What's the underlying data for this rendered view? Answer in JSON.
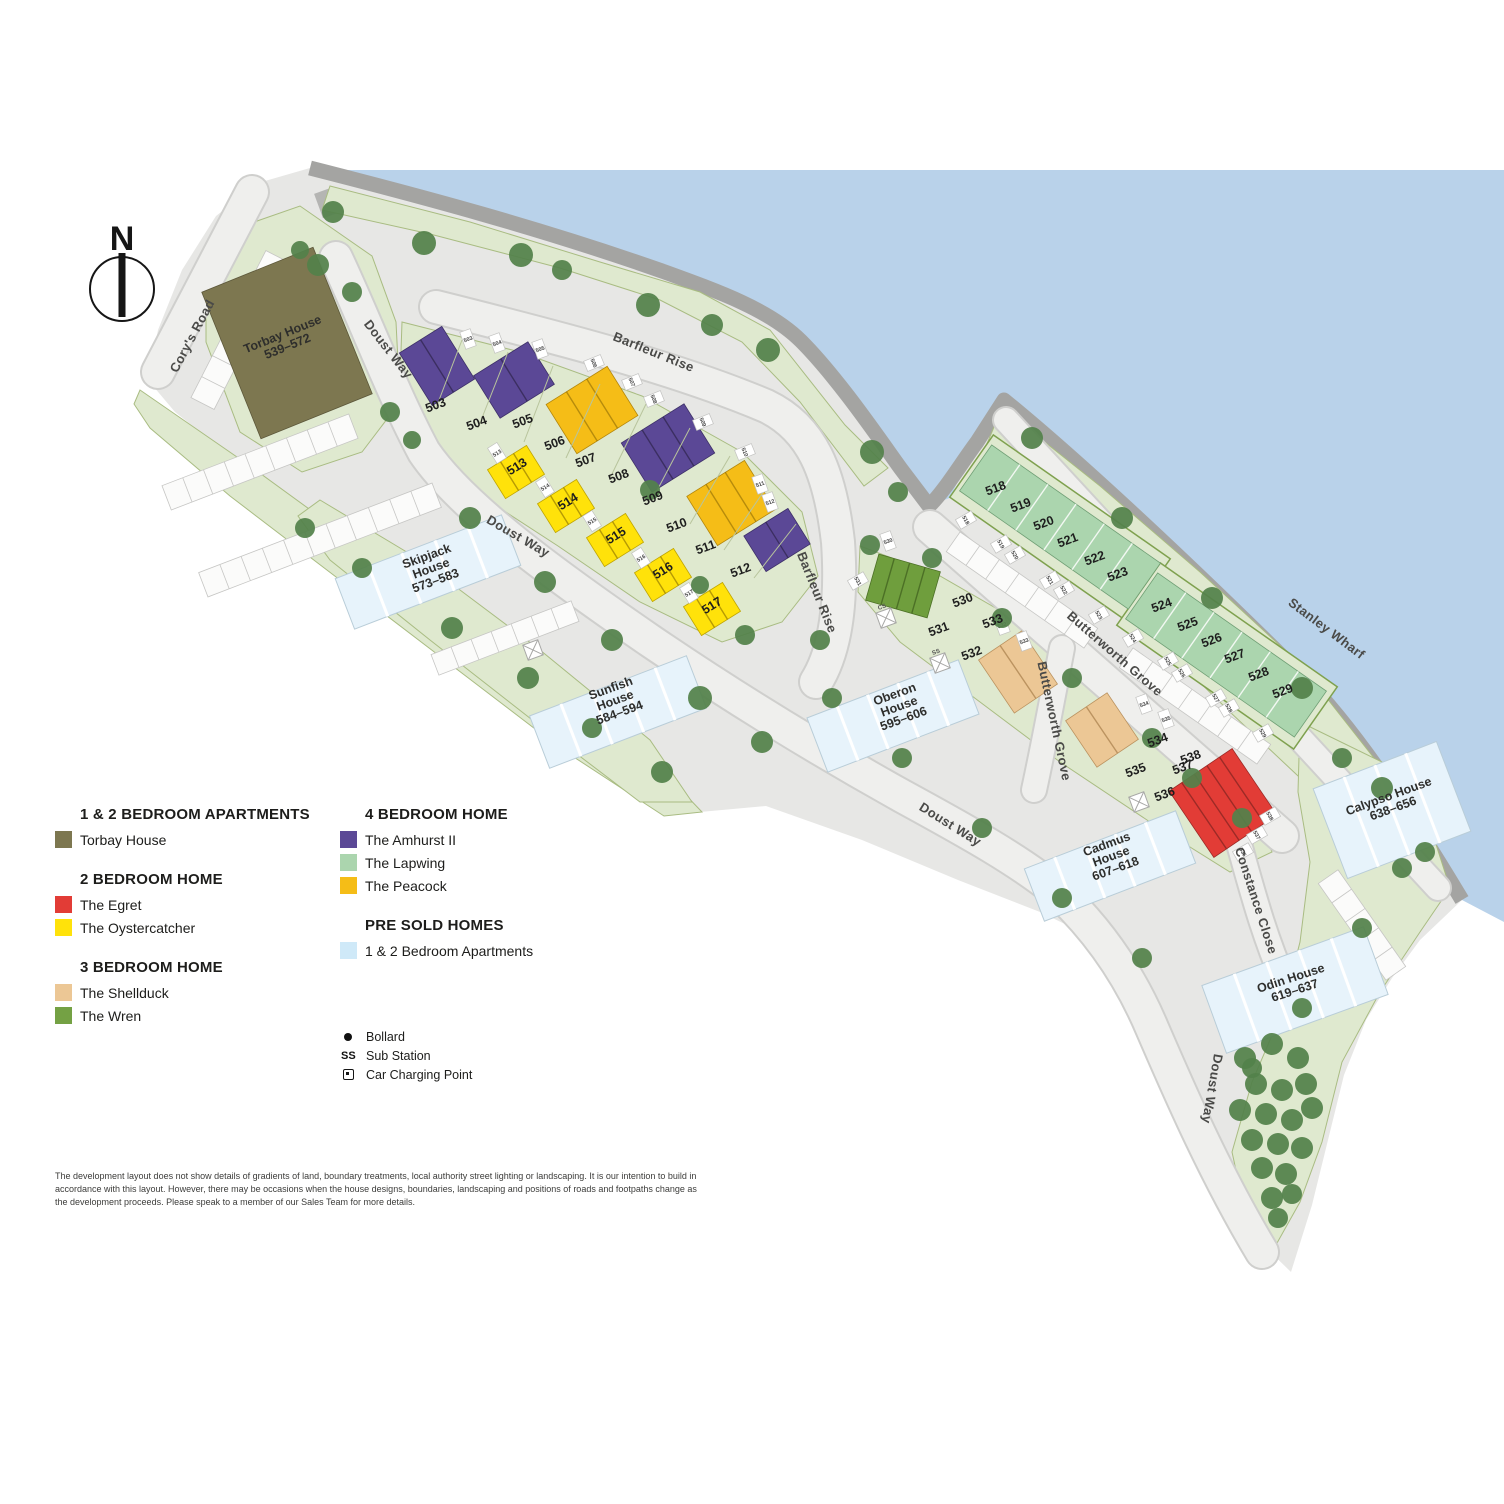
{
  "compass": {
    "label": "N"
  },
  "legend": {
    "sections": [
      {
        "title": "1 & 2 BEDROOM APARTMENTS",
        "items": [
          {
            "label": "Torbay House",
            "color": "#7d7750"
          }
        ]
      },
      {
        "title": "2 BEDROOM HOME",
        "items": [
          {
            "label": "The Egret",
            "color": "#e23c36"
          },
          {
            "label": "The Oystercatcher",
            "color": "#ffe20a"
          }
        ]
      },
      {
        "title": "3 BEDROOM HOME",
        "items": [
          {
            "label": "The Shellduck",
            "color": "#ecc795"
          },
          {
            "label": "The Wren",
            "color": "#74a144"
          }
        ]
      },
      {
        "title": "4 BEDROOM HOME",
        "items": [
          {
            "label": "The Amhurst II",
            "color": "#5b4896"
          },
          {
            "label": "The Lapwing",
            "color": "#abd5ae"
          },
          {
            "label": "The Peacock",
            "color": "#f5bd17"
          }
        ]
      },
      {
        "title": "PRE SOLD HOMES",
        "items": [
          {
            "label": "1 & 2 Bedroom Apartments",
            "color": "#cfe9f8"
          }
        ]
      }
    ],
    "symbols": [
      {
        "icon": "bollard",
        "icon_text": "",
        "label": "Bollard"
      },
      {
        "icon": "ss",
        "icon_text": "SS",
        "label": "Sub Station"
      },
      {
        "icon": "car-charging",
        "icon_text": "",
        "label": "Car Charging Point"
      }
    ]
  },
  "map": {
    "roads": {
      "corys": "Cory's Road",
      "doust1": "Doust Way",
      "doust2": "Doust Way",
      "doust3": "Doust Way",
      "doust4": "Doust Way",
      "barfleur1": "Barfleur Rise",
      "barfleur2": "Barfleur Rise",
      "butterworth1": "Butterworth Grove",
      "butterworth2": "Butterworth Grove",
      "stanley": "Stanley Wharf",
      "constance": "Constance Close"
    },
    "houses": {
      "torbay": {
        "lines": [
          "Torbay House",
          "539–572"
        ]
      },
      "skipjack": {
        "lines": [
          "Skipjack",
          "House",
          "573–583"
        ]
      },
      "sunfish": {
        "lines": [
          "Sunfish",
          "House",
          "584–594"
        ]
      },
      "oberon": {
        "lines": [
          "Oberon",
          "House",
          "595–606"
        ]
      },
      "cadmus": {
        "lines": [
          "Cadmus",
          "House",
          "607–618"
        ]
      },
      "odin": {
        "lines": [
          "Odin House",
          "619–637"
        ]
      },
      "calypso": {
        "lines": [
          "Calypso House",
          "638–656"
        ]
      }
    },
    "plots": [
      "503",
      "504",
      "505",
      "506",
      "507",
      "508",
      "509",
      "510",
      "511",
      "512",
      "513",
      "514",
      "515",
      "516",
      "517",
      "518",
      "519",
      "520",
      "521",
      "522",
      "523",
      "524",
      "525",
      "526",
      "527",
      "528",
      "529",
      "530",
      "531",
      "532",
      "533",
      "534",
      "535",
      "536",
      "537",
      "538"
    ],
    "markers": {
      "cs": "CS",
      "ss": "SS"
    }
  },
  "disclaimer": "The development layout does not show details of gradients of land, boundary treatments, local authority street lighting or landscaping. It is our intention to build in accordance with this layout. However, there may be occasions when the house designs, boundaries, landscaping and positions of roads and footpaths change as the development proceeds. Please speak to a member of our Sales Team for more details."
}
